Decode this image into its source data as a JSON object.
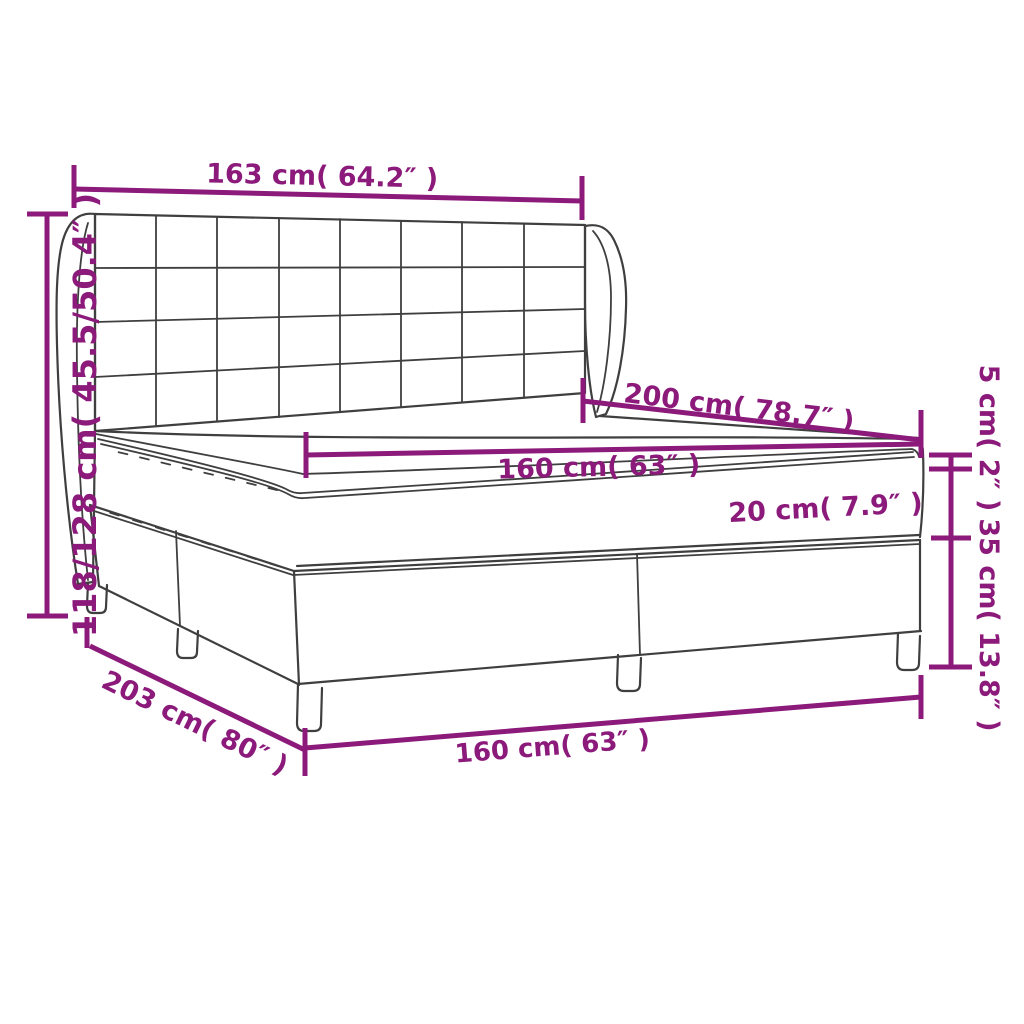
{
  "diagram": {
    "subject": "box-spring-bed-with-headboard-mattress-and-topper-dimension-drawing",
    "accent_color": "#8B1A7B",
    "outline_color": "#3F3F3F",
    "background": "#FFFFFF",
    "labels": {
      "headboard_width": "163 cm( 64.2″ )",
      "height_range": "118/128 cm( 45.5/50.4″ )",
      "bed_length": "200 cm( 78.7″ )",
      "mattress_width": "160 cm( 63″ )",
      "mattress_thickness": "20 cm( 7.9″ )",
      "topper_thickness": "5 cm( 2″ )",
      "base_height": "35 cm( 13.8″ )",
      "total_length": "203 cm( 80″ )",
      "base_width": "160 cm( 63″ )"
    }
  }
}
